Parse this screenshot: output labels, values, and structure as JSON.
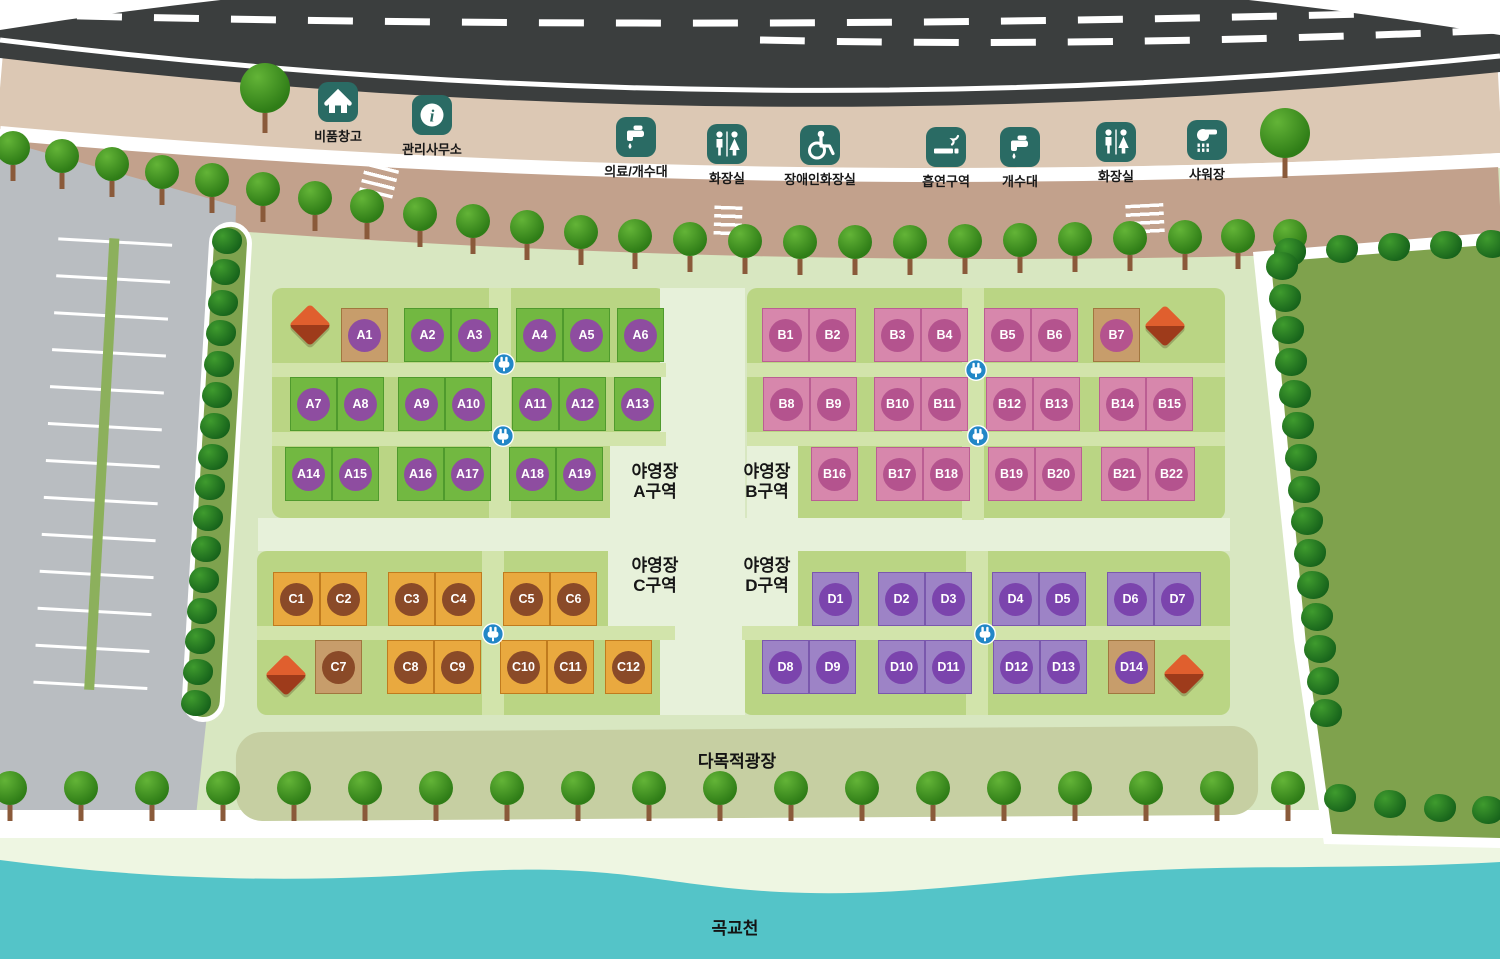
{
  "facilities": [
    {
      "id": "storage",
      "label": "비품창고",
      "icon": "home-icon"
    },
    {
      "id": "office",
      "label": "관리사무소",
      "icon": "info-icon"
    },
    {
      "id": "medical-sink",
      "label": "의료/개수대",
      "icon": "faucet-icon"
    },
    {
      "id": "toilet-west",
      "label": "화장실",
      "icon": "restroom-icon"
    },
    {
      "id": "accessible-toilet",
      "label": "장애인화장실",
      "icon": "wheelchair-icon"
    },
    {
      "id": "smoking-area",
      "label": "흡연구역",
      "icon": "cigarette-icon"
    },
    {
      "id": "sink",
      "label": "개수대",
      "icon": "faucet-icon"
    },
    {
      "id": "toilet-east",
      "label": "화장실",
      "icon": "restroom-icon"
    },
    {
      "id": "shower",
      "label": "샤워장",
      "icon": "shower-icon"
    }
  ],
  "zones": [
    {
      "id": "A",
      "label_line1": "야영장",
      "label_line2": "A구역",
      "site_fill": "#72b841",
      "site_border": "#4f9a2d",
      "circle": "#8e4da0",
      "sites": [
        "A1",
        "A2",
        "A3",
        "A4",
        "A5",
        "A6",
        "A7",
        "A8",
        "A9",
        "A10",
        "A11",
        "A12",
        "A13",
        "A14",
        "A15",
        "A16",
        "A17",
        "A18",
        "A19"
      ]
    },
    {
      "id": "B",
      "label_line1": "야영장",
      "label_line2": "B구역",
      "site_fill": "#d787ac",
      "site_border": "#bb5e93",
      "circle": "#b4538e",
      "sites": [
        "B1",
        "B2",
        "B3",
        "B4",
        "B5",
        "B6",
        "B7",
        "B8",
        "B9",
        "B10",
        "B11",
        "B12",
        "B13",
        "B14",
        "B15",
        "B16",
        "B17",
        "B18",
        "B19",
        "B20",
        "B21",
        "B22"
      ]
    },
    {
      "id": "C",
      "label_line1": "야영장",
      "label_line2": "C구역",
      "site_fill": "#e9a93f",
      "site_border": "#c07b1e",
      "circle": "#8a4a28",
      "sites": [
        "C1",
        "C2",
        "C3",
        "C4",
        "C5",
        "C6",
        "C7",
        "C8",
        "C9",
        "C10",
        "C11",
        "C12"
      ]
    },
    {
      "id": "D",
      "label_line1": "야영장",
      "label_line2": "D구역",
      "site_fill": "#9d83c6",
      "site_border": "#7a58ad",
      "circle": "#7b44ad",
      "sites": [
        "D1",
        "D2",
        "D3",
        "D4",
        "D5",
        "D6",
        "D7",
        "D8",
        "D9",
        "D10",
        "D11",
        "D12",
        "D13",
        "D14"
      ]
    }
  ],
  "areas": {
    "plaza": "다목적광장",
    "river": "곡교천"
  },
  "colors": {
    "facility_icon_bg": "#2a6b64",
    "plug_marker": "#2287c7",
    "water": "#54c4c8",
    "road": "#3b3e3e",
    "tan_site_fill": "#c79d6b",
    "tan_site_border": "#a1763f",
    "panel_green": "#bad584",
    "camp_green": "#d8e7c1",
    "plaza_sage": "#c6cfa2",
    "parking_gray": "#b9bdc1",
    "field_green": "#7fa24d"
  }
}
